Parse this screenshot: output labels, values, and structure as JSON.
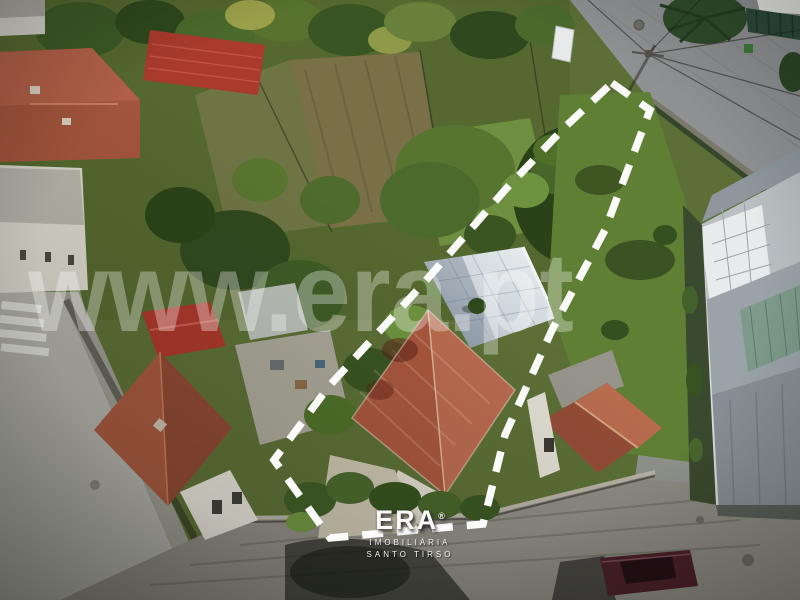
{
  "watermark": {
    "text": "www.era.pt",
    "color": "#ffffff",
    "opacity": 0.32
  },
  "logo": {
    "brand": "ERA",
    "registered": "®",
    "line1": "IMOBILIÁRIA",
    "line2": "SANTO TIRSO"
  },
  "boundary": {
    "points": "612,83 650,110 605,230 552,330 505,435 483,524 330,538 274,460 330,385 422,285 505,190 565,127",
    "color": "#ffffff",
    "dash_pattern": "21 14",
    "stroke_width": 7.5
  },
  "palette": {
    "terracotta_roof": "#a8573d",
    "terracotta_roof_light": "#b96a4e",
    "terracotta_roof_dark": "#8f4936",
    "red_metal_roof": "#ab372b",
    "white_terrace": "#dfe3e6",
    "grass_lawn": "#5f8034",
    "dark_tree": "#2b4218",
    "garden_soil": "#7a7048",
    "asphalt_road": "#afaea7",
    "cobble_street": "#8e8e88",
    "industrial_roof": "#9aa3a8",
    "glass_roof": "#7d9a8a",
    "boundary_line": "#ffffff",
    "car_maroon": "#4a2028"
  }
}
